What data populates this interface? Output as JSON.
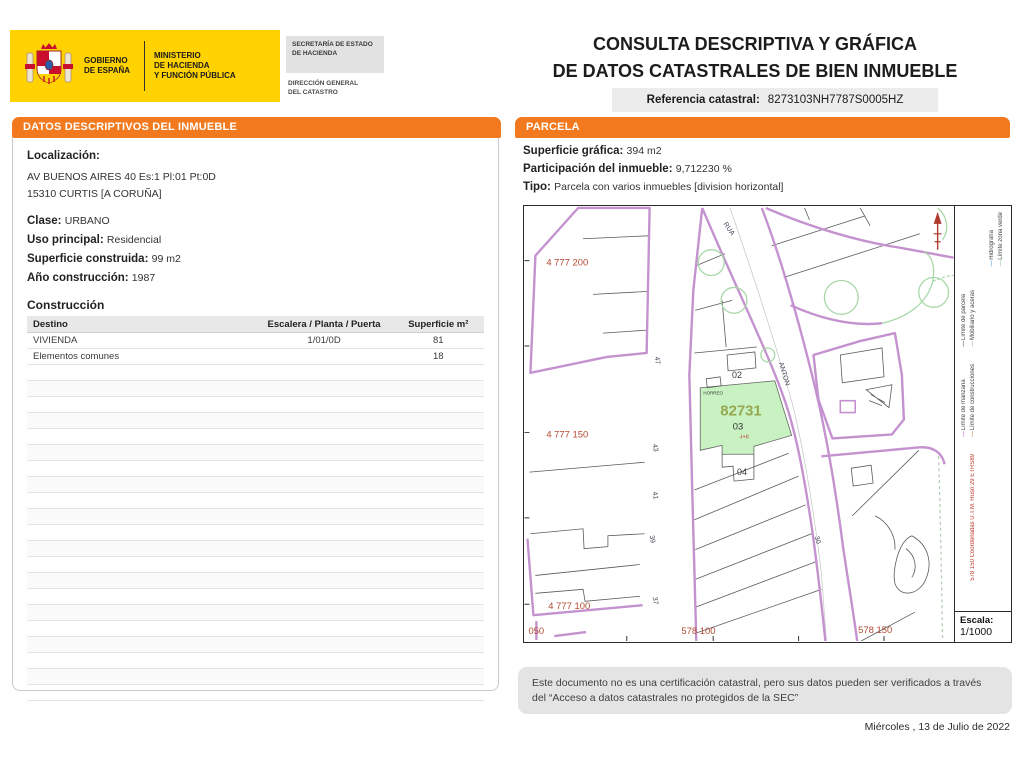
{
  "header": {
    "logo": {
      "gobierno": "GOBIERNO\nDE ESPAÑA",
      "ministerio": "MINISTERIO\nDE HACIENDA\nY FUNCIÓN PÚBLICA",
      "secretaria": "SECRETARÍA DE ESTADO\nDE HACIENDA",
      "direccion": "DIRECCIÓN GENERAL\nDEL CATASTRO"
    },
    "title_line1": "CONSULTA DESCRIPTIVA Y GRÁFICA",
    "title_line2": "DE DATOS CATASTRALES DE BIEN INMUEBLE",
    "ref_label": "Referencia catastral:",
    "ref_value": "8273103NH7787S0005HZ"
  },
  "left_panel": {
    "banner": "DATOS DESCRIPTIVOS DEL INMUEBLE",
    "localizacion_label": "Localización:",
    "address_line1": "AV BUENOS AIRES 40 Es:1 Pl:01 Pt:0D",
    "address_line2": "15310 CURTIS [A CORUÑA]",
    "fields": [
      {
        "label": "Clase:",
        "value": "URBANO"
      },
      {
        "label": "Uso principal:",
        "value": "Residencial"
      },
      {
        "label": "Superficie construida:",
        "value": "99 m2"
      },
      {
        "label": "Año construcción:",
        "value": "1987"
      }
    ],
    "construccion_title": "Construcción",
    "table": {
      "headers": [
        "Destino",
        "Escalera / Planta / Puerta",
        "Superficie m²"
      ],
      "rows": [
        [
          "VIVIENDA",
          "1/01/0D",
          "81"
        ],
        [
          "Elementos comunes",
          "",
          "18"
        ]
      ]
    }
  },
  "right_panel": {
    "banner": "PARCELA",
    "fields": [
      {
        "label": "Superficie gráfica:",
        "value": "394 m2"
      },
      {
        "label": "Participación del inmueble:",
        "value": "9,712230 %"
      },
      {
        "label": "Tipo:",
        "value": "Parcela con varios inmuebles [division horizontal]"
      }
    ],
    "map": {
      "parcel_id": "82731",
      "parcel_number": "03",
      "floors": "-I+II",
      "parcel_02": "02",
      "parcel_04": "04",
      "horreo": "HORREO",
      "street_rua": "RUA",
      "street_anton": "ANTON",
      "house_numbers": [
        "47",
        "43",
        "41",
        "39",
        "37"
      ],
      "other_number": "30",
      "coords_y": [
        "4 777 200",
        "4 777 150",
        "4 777 100"
      ],
      "coords_x": [
        "050",
        "578 100",
        "578 150"
      ],
      "legend": {
        "items": [
          {
            "label": "Hidrografía",
            "color": "#7fb2d9"
          },
          {
            "label": "Límite zona verde",
            "color": "#9fd49f"
          },
          {
            "label": "Límite de parcela",
            "color": "#777777"
          },
          {
            "label": "Mobiliario y aceras",
            "color": "#bbbbbb"
          },
          {
            "label": "Límite de manzana",
            "color": "#d883d8"
          },
          {
            "label": "Límite de construcciones",
            "color": "#cf9a76"
          }
        ],
        "coords_note": "578 150 Coordenadas U.T.M. Huso 29 ETRS89"
      },
      "escala_label": "Escala:",
      "escala_value": "1/1000"
    }
  },
  "footer": {
    "disclaimer": "Este documento no es una certificación catastral, pero sus datos pueden ser verificados a través del “Acceso a datos catastrales no protegidos de la SEC”",
    "date": "Miércoles , 13 de Julio de 2022"
  },
  "colors": {
    "accent_orange": "#F2791D",
    "logo_yellow": "#FFD200",
    "map_purple": "#C492CF",
    "parcel_green_fill": "#C9F2C2",
    "parcel_id_olive": "#95A850",
    "map_label_red": "#B04A31"
  }
}
